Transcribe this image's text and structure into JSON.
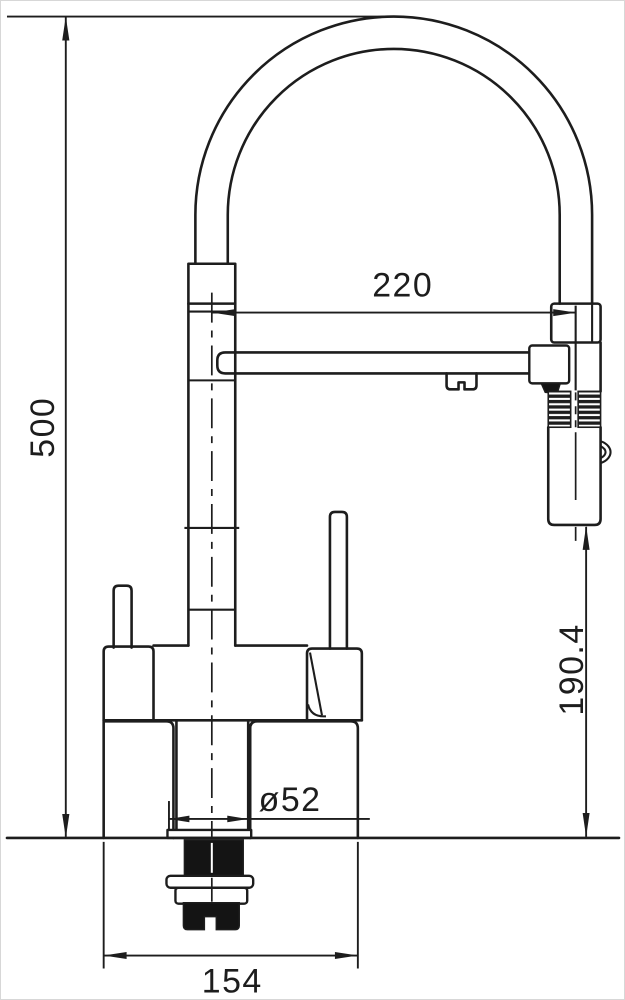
{
  "drawing": {
    "type": "kitchen-faucet-dimension-drawing",
    "colors": {
      "line": "#1d1d1d",
      "background": "#ffffff",
      "frame": "#d7d7d7"
    }
  },
  "dimensions": {
    "overall_height": "500",
    "spout_reach": "220",
    "spray_head_to_counter": "190.4",
    "mounting_hole_diameter": "ø52",
    "body_width": "154"
  }
}
